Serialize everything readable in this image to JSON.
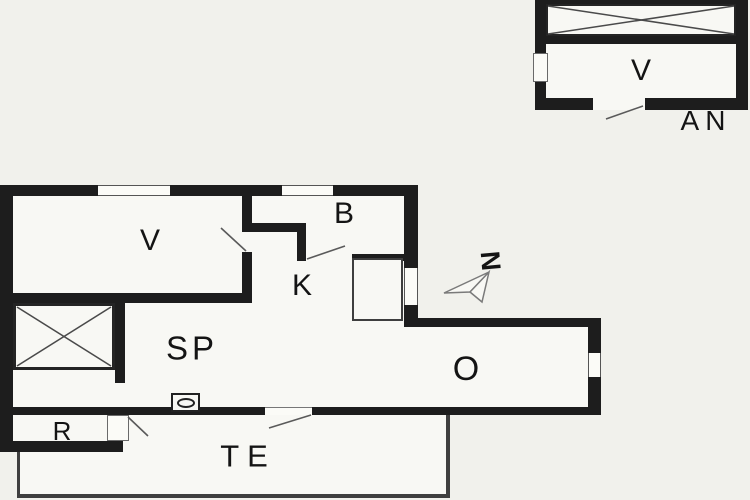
{
  "document": {
    "type": "floor-plan-drawing",
    "buildings": [
      "main-house",
      "annex"
    ]
  },
  "colors": {
    "background": "#f1f1ec",
    "room_fill": "#f8f8f4",
    "wall": "#1d1d1d",
    "thin_line": "#3f3f3f",
    "door_swing_line": "#5a5a5a",
    "text": "#141414"
  },
  "rooms": [
    {
      "key": "v-main",
      "label": "V"
    },
    {
      "key": "b",
      "label": "B"
    },
    {
      "key": "k",
      "label": "K"
    },
    {
      "key": "sp",
      "label": "SP"
    },
    {
      "key": "o",
      "label": "O"
    },
    {
      "key": "r",
      "label": "R"
    },
    {
      "key": "terrace",
      "label": "TE"
    },
    {
      "key": "v-annex",
      "label": "V"
    },
    {
      "key": "annex",
      "label": "AN"
    }
  ],
  "compass": {
    "north_label": "N"
  }
}
